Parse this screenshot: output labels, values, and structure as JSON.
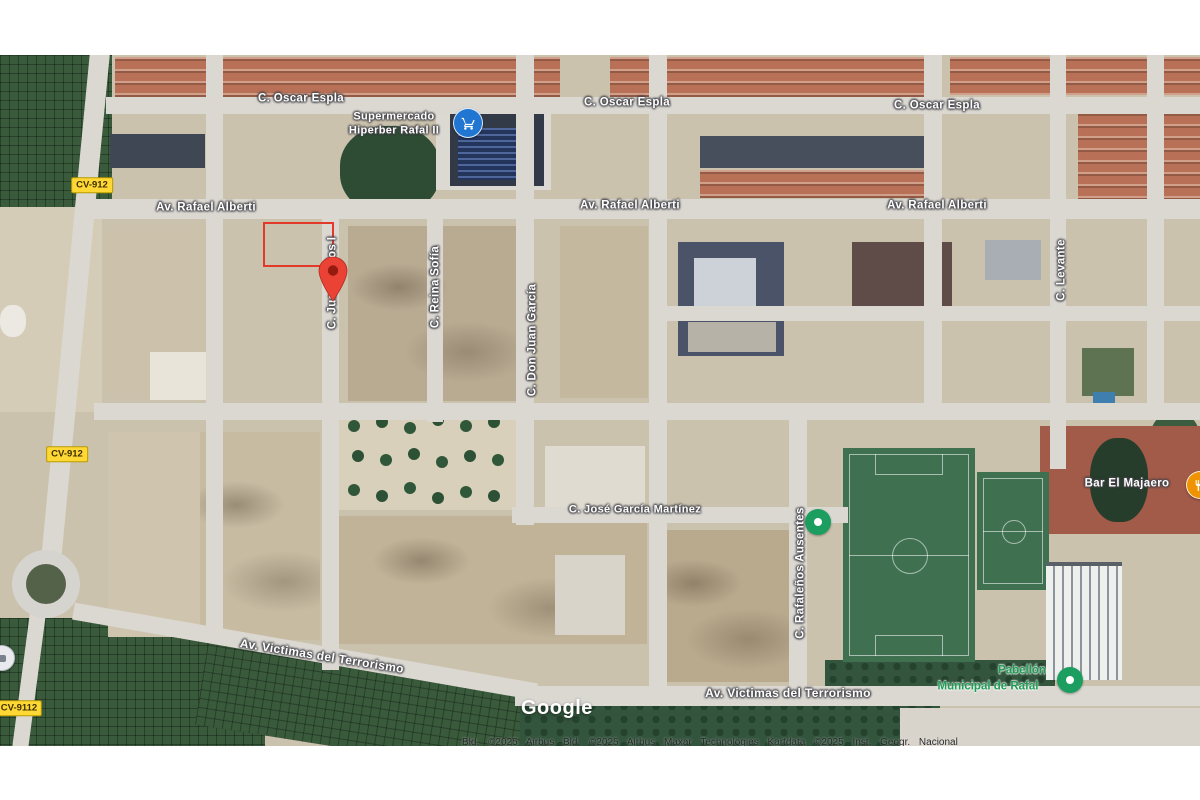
{
  "map": {
    "type": "satellite",
    "provider_logo": "Google",
    "attribution": "Bld. ©2025 Airbus   Bld. ©2025 Airbus   Maxar Technologies   Kartdata ©2025 Inst. Geogr. Nacional",
    "road_shields": [
      {
        "label": "CV-912"
      },
      {
        "label": "CV-912"
      },
      {
        "label": "CV-9112"
      }
    ],
    "street_labels": [
      {
        "text": "C. Oscar Espla"
      },
      {
        "text": "C. Oscar Espla"
      },
      {
        "text": "C. Oscar Espla"
      },
      {
        "text": "Av. Rafael Alberti"
      },
      {
        "text": "Av. Rafael Alberti"
      },
      {
        "text": "Av. Rafael Alberti"
      },
      {
        "text": "C. Juan Carlos I"
      },
      {
        "text": "C. Reina Sofía"
      },
      {
        "text": "C. Don Juan García"
      },
      {
        "text": "C. Levante"
      },
      {
        "text": "C. José García Martínez"
      },
      {
        "text": "C. Rafaleños Ausentes"
      },
      {
        "text": "Av. Victimas del Terrorismo"
      },
      {
        "text": "Av. Victimas del Terrorismo"
      }
    ],
    "poi_labels": {
      "supermarket": {
        "line1": "Supermercado",
        "line2": "Hiperber Rafal II",
        "icon": "shopping-cart-pin",
        "pin_color": "#2176D2"
      },
      "bar": {
        "name": "Bar El Majaero",
        "icon": "restaurant-pin",
        "pin_color": "#F09300"
      },
      "pavilion": {
        "line1": "Pabellón",
        "line2": "Municipal de Rafal",
        "icon": "green-place-pin",
        "pin_color": "#1B9E5F"
      }
    },
    "markers": {
      "red_location_pin_color": "#EA4335",
      "red_selection_rectangle_color": "#E2392B",
      "green_place_pin_color": "#1B9E5F",
      "shield_yellow": "#FFD835",
      "label_white": "#FFFFFF",
      "poi_green_text": "#1E9B54"
    }
  }
}
